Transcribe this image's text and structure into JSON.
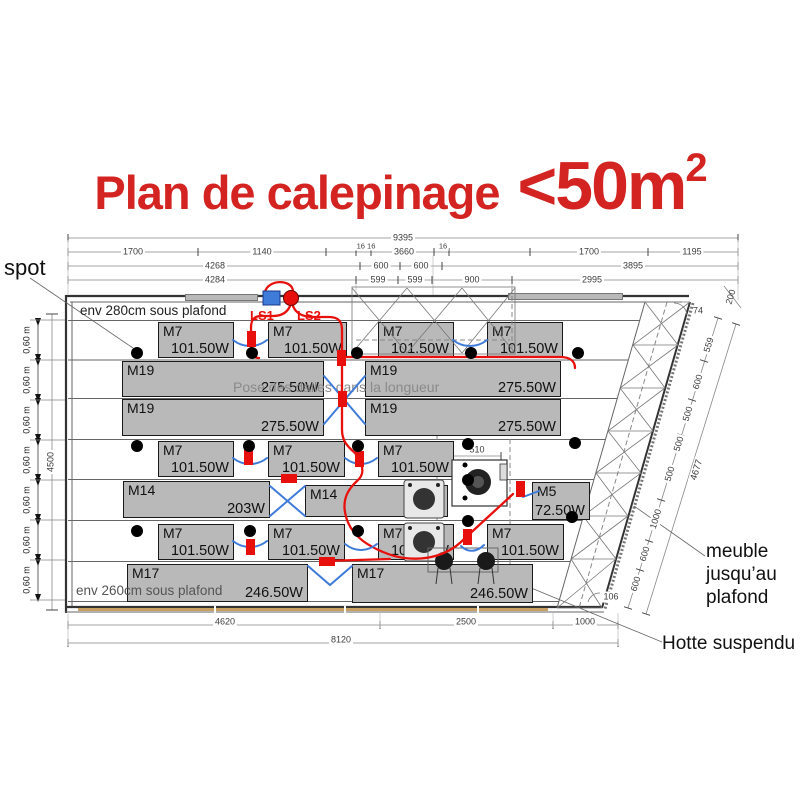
{
  "title": {
    "prefix": "Plan de calepinage",
    "big": "<50m",
    "sup": "2"
  },
  "colors": {
    "title-red": "#d32422",
    "wire-red": "#e8100c",
    "wire-blue": "#3f7bd9",
    "panel-fill": "#b9b9b9",
    "panel-border": "#1a1a1a"
  },
  "panels": [
    {
      "label": "M7",
      "watt": "101.50W",
      "x": 158,
      "y": 322,
      "w": 76,
      "h": 36
    },
    {
      "label": "M7",
      "watt": "101.50W",
      "x": 268,
      "y": 322,
      "w": 79,
      "h": 36
    },
    {
      "label": "M7",
      "watt": "101.50W",
      "x": 378,
      "y": 322,
      "w": 76,
      "h": 36
    },
    {
      "label": "M7",
      "watt": "101.50W",
      "x": 487,
      "y": 322,
      "w": 76,
      "h": 36
    },
    {
      "label": "M19",
      "watt": "275.50W",
      "x": 122,
      "y": 361,
      "w": 202,
      "h": 36
    },
    {
      "label": "M19",
      "watt": "275.50W",
      "x": 365,
      "y": 361,
      "w": 196,
      "h": 36
    },
    {
      "label": "M19",
      "watt": "275.50W",
      "x": 122,
      "y": 399,
      "w": 202,
      "h": 37
    },
    {
      "label": "M19",
      "watt": "275.50W",
      "x": 365,
      "y": 399,
      "w": 196,
      "h": 37
    },
    {
      "label": "M7",
      "watt": "101.50W",
      "x": 158,
      "y": 441,
      "w": 76,
      "h": 36
    },
    {
      "label": "M7",
      "watt": "101.50W",
      "x": 268,
      "y": 441,
      "w": 77,
      "h": 36
    },
    {
      "label": "M7",
      "watt": "101.50W",
      "x": 378,
      "y": 441,
      "w": 76,
      "h": 36
    },
    {
      "label": "M14",
      "watt": "203W",
      "x": 123,
      "y": 481,
      "w": 147,
      "h": 37
    },
    {
      "label": "M14",
      "watt": "203W",
      "x": 305,
      "y": 485,
      "w": 143,
      "h": 32
    },
    {
      "label": "M5",
      "watt": "72.50W",
      "x": 532,
      "y": 482,
      "w": 58,
      "h": 38
    },
    {
      "label": "M7",
      "watt": "101.50W",
      "x": 158,
      "y": 524,
      "w": 76,
      "h": 36
    },
    {
      "label": "M7",
      "watt": "101.50W",
      "x": 268,
      "y": 524,
      "w": 77,
      "h": 36
    },
    {
      "label": "M7",
      "watt": "101.50W",
      "x": 378,
      "y": 524,
      "w": 76,
      "h": 36
    },
    {
      "label": "M7",
      "watt": "101.50W",
      "x": 487,
      "y": 524,
      "w": 77,
      "h": 36
    },
    {
      "label": "M17",
      "watt": "246.50W",
      "x": 127,
      "y": 564,
      "w": 181,
      "h": 38
    },
    {
      "label": "M17",
      "watt": "246.50W",
      "x": 352,
      "y": 564,
      "w": 181,
      "h": 39
    }
  ],
  "spots": [
    {
      "x": 137,
      "y": 353,
      "d": 12
    },
    {
      "x": 252,
      "y": 353,
      "d": 12
    },
    {
      "x": 357,
      "y": 353,
      "d": 12
    },
    {
      "x": 471,
      "y": 353,
      "d": 12
    },
    {
      "x": 578,
      "y": 353,
      "d": 12
    },
    {
      "x": 137,
      "y": 446,
      "d": 12
    },
    {
      "x": 249,
      "y": 446,
      "d": 12
    },
    {
      "x": 358,
      "y": 446,
      "d": 12
    },
    {
      "x": 468,
      "y": 444,
      "d": 12
    },
    {
      "x": 575,
      "y": 443,
      "d": 12
    },
    {
      "x": 137,
      "y": 531,
      "d": 12
    },
    {
      "x": 250,
      "y": 531,
      "d": 12
    },
    {
      "x": 358,
      "y": 531,
      "d": 12
    },
    {
      "x": 468,
      "y": 521,
      "d": 12
    },
    {
      "x": 572,
      "y": 517,
      "d": 12
    },
    {
      "x": 468,
      "y": 480,
      "d": 12
    },
    {
      "x": 465,
      "y": 465,
      "d": 5
    },
    {
      "x": 465,
      "y": 498,
      "d": 5
    }
  ],
  "labels": [
    {
      "text": "9395",
      "x": 403,
      "y": 238,
      "size": 9,
      "color": "#3c3c3c",
      "cc": 1,
      "bg": 1
    },
    {
      "text": "1700",
      "x": 133,
      "y": 252,
      "size": 9,
      "color": "#3c3c3c",
      "cc": 1,
      "bg": 1
    },
    {
      "text": "1140",
      "x": 262,
      "y": 252,
      "size": 9,
      "color": "#3c3c3c",
      "cc": 1,
      "bg": 1
    },
    {
      "text": "16 16",
      "x": 366,
      "y": 246,
      "size": 7.5,
      "color": "#3c3c3c",
      "cc": 1,
      "bg": 1
    },
    {
      "text": "3660",
      "x": 404,
      "y": 252,
      "size": 9,
      "color": "#3c3c3c",
      "cc": 1,
      "bg": 1
    },
    {
      "text": "16",
      "x": 443,
      "y": 246,
      "size": 7.5,
      "color": "#3c3c3c",
      "cc": 1,
      "bg": 1
    },
    {
      "text": "1700",
      "x": 589,
      "y": 252,
      "size": 9,
      "color": "#3c3c3c",
      "cc": 1,
      "bg": 1
    },
    {
      "text": "1195",
      "x": 692,
      "y": 252,
      "size": 9,
      "color": "#3c3c3c",
      "cc": 1,
      "bg": 1
    },
    {
      "text": "4268",
      "x": 215,
      "y": 266,
      "size": 9,
      "color": "#3c3c3c",
      "cc": 1,
      "bg": 1
    },
    {
      "text": "600",
      "x": 381,
      "y": 266,
      "size": 9,
      "color": "#3c3c3c",
      "cc": 1,
      "bg": 1
    },
    {
      "text": "600",
      "x": 421,
      "y": 266,
      "size": 9,
      "color": "#3c3c3c",
      "cc": 1,
      "bg": 1
    },
    {
      "text": "3895",
      "x": 633,
      "y": 266,
      "size": 9,
      "color": "#3c3c3c",
      "cc": 1,
      "bg": 1
    },
    {
      "text": "4284",
      "x": 215,
      "y": 280,
      "size": 9,
      "color": "#3c3c3c",
      "cc": 1,
      "bg": 1
    },
    {
      "text": "599",
      "x": 378,
      "y": 280,
      "size": 9,
      "color": "#3c3c3c",
      "cc": 1,
      "bg": 1
    },
    {
      "text": "599",
      "x": 415,
      "y": 280,
      "size": 9,
      "color": "#3c3c3c",
      "cc": 1,
      "bg": 1
    },
    {
      "text": "900",
      "x": 472,
      "y": 280,
      "size": 9,
      "color": "#3c3c3c",
      "cc": 1,
      "bg": 1
    },
    {
      "text": "2995",
      "x": 592,
      "y": 280,
      "size": 9,
      "color": "#3c3c3c",
      "cc": 1,
      "bg": 1
    },
    {
      "text": "4620",
      "x": 225,
      "y": 622,
      "size": 9,
      "color": "#3c3c3c",
      "cc": 1,
      "bg": 1
    },
    {
      "text": "2500",
      "x": 466,
      "y": 622,
      "size": 9,
      "color": "#3c3c3c",
      "cc": 1,
      "bg": 1
    },
    {
      "text": "1000",
      "x": 585,
      "y": 622,
      "size": 9,
      "color": "#3c3c3c",
      "cc": 1,
      "bg": 1
    },
    {
      "text": "8120",
      "x": 341,
      "y": 640,
      "size": 9,
      "color": "#3c3c3c",
      "cc": 1,
      "bg": 1
    },
    {
      "text": "0,60 m",
      "x": 27,
      "y": 340,
      "size": 9,
      "color": "#222",
      "cc": 1,
      "rot": -90
    },
    {
      "text": "0,60 m",
      "x": 27,
      "y": 380,
      "size": 9,
      "color": "#222",
      "cc": 1,
      "rot": -90
    },
    {
      "text": "0,60 m",
      "x": 27,
      "y": 420,
      "size": 9,
      "color": "#222",
      "cc": 1,
      "rot": -90
    },
    {
      "text": "0,60 m",
      "x": 27,
      "y": 460,
      "size": 9,
      "color": "#222",
      "cc": 1,
      "rot": -90
    },
    {
      "text": "0,60 m",
      "x": 27,
      "y": 500,
      "size": 9,
      "color": "#222",
      "cc": 1,
      "rot": -90
    },
    {
      "text": "0,60 m",
      "x": 27,
      "y": 540,
      "size": 9,
      "color": "#222",
      "cc": 1,
      "rot": -90
    },
    {
      "text": "0,60 m",
      "x": 27,
      "y": 580,
      "size": 9,
      "color": "#222",
      "cc": 1,
      "rot": -90
    },
    {
      "text": "4500",
      "x": 51,
      "y": 462,
      "size": 9,
      "color": "#3c3c3c",
      "cc": 1,
      "rot": -90,
      "bg": 1
    },
    {
      "text": "559",
      "x": 709,
      "y": 345,
      "size": 9,
      "color": "#3c3c3c",
      "cc": 1,
      "rot": -73,
      "bg": 1
    },
    {
      "text": "600",
      "x": 698,
      "y": 382,
      "size": 9,
      "color": "#3c3c3c",
      "cc": 1,
      "rot": -73,
      "bg": 1
    },
    {
      "text": "500",
      "x": 688,
      "y": 414,
      "size": 9,
      "color": "#3c3c3c",
      "cc": 1,
      "rot": -73,
      "bg": 1
    },
    {
      "text": "500",
      "x": 679,
      "y": 444,
      "size": 9,
      "color": "#3c3c3c",
      "cc": 1,
      "rot": -73,
      "bg": 1
    },
    {
      "text": "500",
      "x": 670,
      "y": 474,
      "size": 9,
      "color": "#3c3c3c",
      "cc": 1,
      "rot": -73,
      "bg": 1
    },
    {
      "text": "1000",
      "x": 656,
      "y": 519,
      "size": 9,
      "color": "#3c3c3c",
      "cc": 1,
      "rot": -73,
      "bg": 1
    },
    {
      "text": "600",
      "x": 645,
      "y": 554,
      "size": 9,
      "color": "#3c3c3c",
      "cc": 1,
      "rot": -73,
      "bg": 1
    },
    {
      "text": "600",
      "x": 636,
      "y": 584,
      "size": 9,
      "color": "#3c3c3c",
      "cc": 1,
      "rot": -73,
      "bg": 1
    },
    {
      "text": "4677",
      "x": 697,
      "y": 470,
      "size": 9.5,
      "color": "#3c3c3c",
      "cc": 1,
      "rot": -73,
      "bg": 1
    },
    {
      "text": "200",
      "x": 731,
      "y": 297,
      "size": 9,
      "color": "#3c3c3c",
      "cc": 1,
      "rot": -73
    },
    {
      "text": "74",
      "x": 698,
      "y": 311,
      "size": 9,
      "color": "#3c3c3c",
      "cc": 1
    },
    {
      "text": "106",
      "x": 611,
      "y": 597,
      "size": 9,
      "color": "#3c3c3c",
      "cc": 1,
      "bg": 1
    },
    {
      "text": "510",
      "x": 477,
      "y": 450,
      "size": 9,
      "color": "#3c3c3c",
      "cc": 1,
      "bg": 1
    },
    {
      "text": "spot",
      "x": 4,
      "y": 255,
      "size": 22,
      "color": "#111"
    },
    {
      "text": "env 280cm sous plafond",
      "x": 80,
      "y": 303,
      "size": 13.5,
      "color": "#222"
    },
    {
      "text": "env 260cm sous plafond",
      "x": 76,
      "y": 583,
      "size": 13.5,
      "color": "#555"
    },
    {
      "text": "Pose des dalles dans la longueur",
      "x": 233,
      "y": 379,
      "size": 14,
      "color": "#8a8a8a"
    },
    {
      "text": "LS1",
      "x": 250,
      "y": 308,
      "size": 13,
      "color": "#e8100c",
      "bold": 1
    },
    {
      "text": "LS2",
      "x": 297,
      "y": 308,
      "size": 13,
      "color": "#e8100c",
      "bold": 1
    },
    {
      "text": "meuble\njusqu’au\nplafond",
      "x": 706,
      "y": 540,
      "size": 19,
      "color": "#111"
    },
    {
      "text": "Hotte suspendu",
      "x": 662,
      "y": 632,
      "size": 19,
      "color": "#111"
    }
  ]
}
